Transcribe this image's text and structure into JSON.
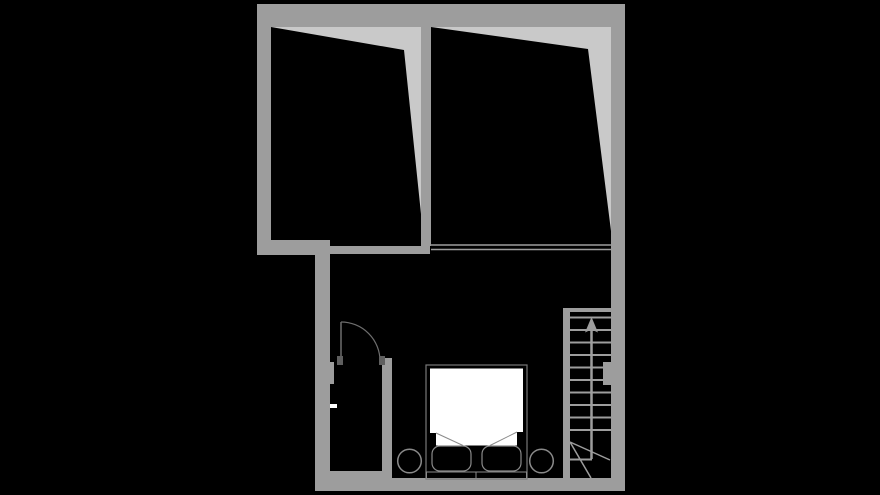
{
  "canvas": {
    "width": 880,
    "height": 495,
    "background": "#000000"
  },
  "palette": {
    "background": "#000000",
    "wall_gray": "#9d9d9d",
    "low_ceiling_gray": "#c9c9c9",
    "thin_outline_gray": "#6e6e6e",
    "furniture_outline_gray": "#8a8a8a",
    "door_jamb_gray": "#5f5f5f",
    "white": "#ffffff"
  },
  "floor_plan": {
    "layers": [
      {
        "name": "low-headroom-areas",
        "shapes": [
          {
            "name": "left-room-low-ceiling-wedge",
            "type": "polygon",
            "points": "271,27 421,27 421,214 404,50",
            "fill": "#c9c9c9"
          },
          {
            "name": "right-room-low-ceiling-wedge",
            "type": "polygon",
            "points": "431,27 611,27 611,231 588,49",
            "fill": "#c9c9c9"
          }
        ]
      },
      {
        "name": "walls",
        "shapes": [
          {
            "name": "north-exterior-wall",
            "type": "rect",
            "x": 257,
            "y": 4,
            "w": 368,
            "h": 23,
            "fill": "#9d9d9d"
          },
          {
            "name": "west-exterior-wall-upper",
            "type": "rect",
            "x": 257,
            "y": 4,
            "w": 14,
            "h": 251,
            "fill": "#9d9d9d"
          },
          {
            "name": "east-exterior-wall",
            "type": "rect",
            "x": 611,
            "y": 4,
            "w": 14,
            "h": 487,
            "fill": "#9d9d9d"
          },
          {
            "name": "room-divider-wall",
            "type": "rect",
            "x": 421,
            "y": 27,
            "w": 10,
            "h": 219,
            "fill": "#9d9d9d"
          },
          {
            "name": "left-room-south-wall",
            "type": "rect",
            "x": 257,
            "y": 240,
            "w": 73,
            "h": 15,
            "fill": "#9d9d9d"
          },
          {
            "name": "hall-north-wall",
            "type": "rect",
            "x": 330,
            "y": 246,
            "w": 100,
            "h": 8,
            "fill": "#9d9d9d"
          },
          {
            "name": "west-exterior-wall-lower",
            "type": "rect",
            "x": 315,
            "y": 255,
            "w": 15,
            "h": 236,
            "fill": "#9d9d9d"
          },
          {
            "name": "south-exterior-wall",
            "type": "rect",
            "x": 315,
            "y": 478,
            "w": 310,
            "h": 13,
            "fill": "#9d9d9d"
          },
          {
            "name": "closet-east-wall",
            "type": "rect",
            "x": 382,
            "y": 358,
            "w": 10,
            "h": 115,
            "fill": "#9d9d9d"
          },
          {
            "name": "closet-south-wall",
            "type": "rect",
            "x": 330,
            "y": 471,
            "w": 62,
            "h": 9,
            "fill": "#9d9d9d"
          },
          {
            "name": "closet-west-wall-nub",
            "type": "rect",
            "x": 330,
            "y": 362,
            "w": 4,
            "h": 22,
            "fill": "#9d9d9d"
          }
        ]
      },
      {
        "name": "ceiling-edge-lines",
        "shapes": [
          {
            "name": "edge-line-upper",
            "type": "line",
            "x1": 431,
            "y1": 245,
            "x2": 611,
            "y2": 245,
            "stroke": "#9d9d9d",
            "width": 1.6
          },
          {
            "name": "edge-line-lower",
            "type": "line",
            "x1": 431,
            "y1": 249.5,
            "x2": 611,
            "y2": 249.5,
            "stroke": "#9d9d9d",
            "width": 1.6
          }
        ]
      },
      {
        "name": "staircase",
        "shapes": [
          {
            "name": "stair-stringer-wall",
            "type": "rect",
            "x": 563,
            "y": 308,
            "w": 7,
            "h": 172,
            "fill": "#9d9d9d"
          },
          {
            "name": "stair-top-landing-edge",
            "type": "rect",
            "x": 563,
            "y": 308,
            "w": 48,
            "h": 4,
            "fill": "#9d9d9d"
          },
          {
            "name": "stair-wall-nib",
            "type": "rect",
            "x": 603,
            "y": 362,
            "w": 8,
            "h": 23,
            "fill": "#9d9d9d"
          },
          {
            "name": "stair-tread-1",
            "type": "line",
            "x1": 570,
            "y1": 317.5,
            "x2": 611,
            "y2": 317.5,
            "stroke": "#9d9d9d",
            "width": 2
          },
          {
            "name": "stair-tread-2",
            "type": "line",
            "x1": 570,
            "y1": 330,
            "x2": 611,
            "y2": 330,
            "stroke": "#9d9d9d",
            "width": 2
          },
          {
            "name": "stair-tread-3",
            "type": "line",
            "x1": 570,
            "y1": 342.5,
            "x2": 611,
            "y2": 342.5,
            "stroke": "#9d9d9d",
            "width": 2
          },
          {
            "name": "stair-tread-4",
            "type": "line",
            "x1": 570,
            "y1": 355,
            "x2": 611,
            "y2": 355,
            "stroke": "#9d9d9d",
            "width": 2
          },
          {
            "name": "stair-tread-5",
            "type": "line",
            "x1": 570,
            "y1": 367.5,
            "x2": 611,
            "y2": 367.5,
            "stroke": "#9d9d9d",
            "width": 2
          },
          {
            "name": "stair-tread-6",
            "type": "line",
            "x1": 570,
            "y1": 380,
            "x2": 611,
            "y2": 380,
            "stroke": "#9d9d9d",
            "width": 2
          },
          {
            "name": "stair-tread-7",
            "type": "line",
            "x1": 570,
            "y1": 392.5,
            "x2": 611,
            "y2": 392.5,
            "stroke": "#9d9d9d",
            "width": 2
          },
          {
            "name": "stair-tread-8",
            "type": "line",
            "x1": 570,
            "y1": 405,
            "x2": 611,
            "y2": 405,
            "stroke": "#9d9d9d",
            "width": 2
          },
          {
            "name": "stair-tread-9",
            "type": "line",
            "x1": 570,
            "y1": 417.5,
            "x2": 611,
            "y2": 417.5,
            "stroke": "#9d9d9d",
            "width": 2
          },
          {
            "name": "stair-tread-10",
            "type": "line",
            "x1": 570,
            "y1": 430,
            "x2": 611,
            "y2": 430,
            "stroke": "#9d9d9d",
            "width": 2
          },
          {
            "name": "stair-half-tread",
            "type": "line",
            "x1": 570,
            "y1": 459.5,
            "x2": 592,
            "y2": 459.5,
            "stroke": "#9d9d9d",
            "width": 2
          },
          {
            "name": "stair-break-line-1",
            "type": "line",
            "x1": 570,
            "y1": 442,
            "x2": 610,
            "y2": 460,
            "stroke": "#9d9d9d",
            "width": 1.5
          },
          {
            "name": "stair-break-line-2",
            "type": "line",
            "x1": 570,
            "y1": 442,
            "x2": 591,
            "y2": 478,
            "stroke": "#9d9d9d",
            "width": 1.5
          },
          {
            "name": "stair-direction-arrow-shaft",
            "type": "line",
            "x1": 591.5,
            "y1": 459,
            "x2": 591.5,
            "y2": 330,
            "stroke": "#9d9d9d",
            "width": 2.5
          },
          {
            "name": "stair-direction-arrow-head",
            "type": "polygon",
            "points": "585,332.5 591.5,317 598,332.5 591.5,329.5",
            "fill": "#9d9d9d"
          }
        ]
      },
      {
        "name": "door",
        "shapes": [
          {
            "name": "door-leaf",
            "type": "line",
            "x1": 341,
            "y1": 322,
            "x2": 341,
            "y2": 360,
            "stroke": "#6e6e6e",
            "width": 1.5
          },
          {
            "name": "door-swing-arc",
            "type": "path",
            "d": "M 341 322 A 39 39 0 0 1 380 361",
            "fill": "none",
            "stroke": "#6e6e6e",
            "width": 1.2
          },
          {
            "name": "door-jamb-left",
            "type": "rect",
            "x": 337,
            "y": 356,
            "w": 6,
            "h": 9,
            "fill": "#5f5f5f"
          },
          {
            "name": "door-jamb-right",
            "type": "rect",
            "x": 379,
            "y": 356,
            "w": 6,
            "h": 9,
            "fill": "#5f5f5f"
          },
          {
            "name": "wall-opening-marker",
            "type": "rect",
            "x": 330,
            "y": 404,
            "w": 7,
            "h": 4,
            "fill": "#ffffff"
          }
        ]
      },
      {
        "name": "bed",
        "shapes": [
          {
            "name": "bed-frame",
            "type": "rect",
            "x": 426,
            "y": 365,
            "w": 101,
            "h": 114,
            "fill": "#000000",
            "stroke": "#787878",
            "width": 1.2
          },
          {
            "name": "bed-mattress",
            "type": "polygon",
            "points": "430,368.5 523,368.5 523,432 517,432 517,445.5 436,445.5 436,433 430,433",
            "fill": "#ffffff"
          },
          {
            "name": "bed-sheet-fold-left",
            "type": "line",
            "x1": 436,
            "y1": 433,
            "x2": 463,
            "y2": 445.5,
            "stroke": "#8a8a8a",
            "width": 1
          },
          {
            "name": "bed-sheet-fold-right",
            "type": "line",
            "x1": 517,
            "y1": 432,
            "x2": 490,
            "y2": 445.5,
            "stroke": "#8a8a8a",
            "width": 1
          },
          {
            "name": "bed-pillow-left",
            "type": "rect",
            "x": 432,
            "y": 446,
            "w": 39,
            "h": 25,
            "rx": 8,
            "fill": "#000000",
            "stroke": "#8a8a8a",
            "width": 1.2
          },
          {
            "name": "bed-pillow-right",
            "type": "rect",
            "x": 482,
            "y": 446,
            "w": 39,
            "h": 25,
            "rx": 8,
            "fill": "#000000",
            "stroke": "#8a8a8a",
            "width": 1.2
          },
          {
            "name": "bed-headboard-left",
            "type": "rect",
            "x": 426.5,
            "y": 472,
            "w": 49.5,
            "h": 6.5,
            "fill": "#000000",
            "stroke": "#8a8a8a",
            "width": 1
          },
          {
            "name": "bed-headboard-right",
            "type": "rect",
            "x": 476,
            "y": 472,
            "w": 50.5,
            "h": 6.5,
            "fill": "#000000",
            "stroke": "#8a8a8a",
            "width": 1
          }
        ]
      },
      {
        "name": "nightstands",
        "shapes": [
          {
            "name": "nightstand-left",
            "type": "circle",
            "cx": 409.5,
            "cy": 461,
            "r": 11.8,
            "fill": "#000000",
            "stroke": "#8a8a8a",
            "width": 1.5
          },
          {
            "name": "nightstand-right",
            "type": "circle",
            "cx": 541.5,
            "cy": 461,
            "r": 11.8,
            "fill": "#000000",
            "stroke": "#8a8a8a",
            "width": 1.5
          }
        ]
      }
    ]
  }
}
